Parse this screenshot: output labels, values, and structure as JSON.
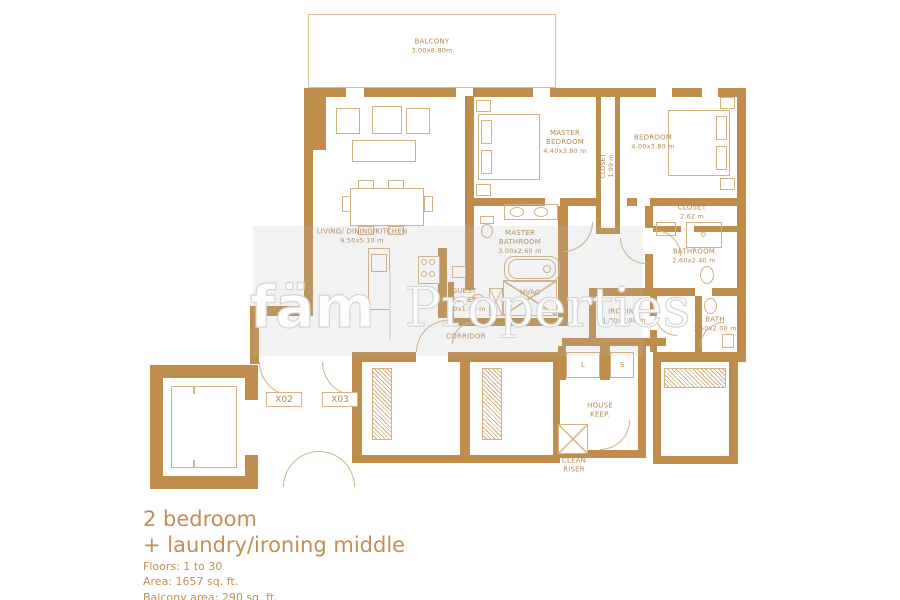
{
  "watermark": {
    "brand": "fäm",
    "name": "Properties"
  },
  "plan": {
    "balcony": {
      "name": "BALCONY",
      "dim": "3.00x8.80m"
    },
    "living": {
      "name": "LIVING/ DINING/KITCHEN",
      "dim": "9.50x5.10 m"
    },
    "master_bedroom": {
      "l1": "MASTER",
      "l2": "BEDROOM",
      "dim": "4.40x3.80 m"
    },
    "bedroom": {
      "name": "BEDROOM",
      "dim": "4.00x3.80 m"
    },
    "closet1": {
      "name": "CLOSET",
      "dim": "1.99 m"
    },
    "master_bathroom": {
      "l1": "MASTER",
      "l2": "BATHROOM",
      "dim": "3.00x2.60 m"
    },
    "guest_toilet": {
      "l1": "GUEST",
      "l2": "TOILET",
      "dim": "1.70x1.50 m"
    },
    "hvac": {
      "name": "HVAC"
    },
    "corridor": {
      "name": "CORRIDOR"
    },
    "closet2": {
      "name": "CLOSET",
      "dim": "2.62 m"
    },
    "bathroom": {
      "name": "BATHROOM",
      "dim": "2.60x2.40 m"
    },
    "bath": {
      "name": "BATH",
      "dim": "1.50x2.00 m"
    },
    "ironing": {
      "name": "IRONING",
      "dim": "1.80x2.00 m"
    },
    "house_keep": {
      "l1": "HOUSE",
      "l2": "KEEP."
    },
    "clean_riser": {
      "l1": "CLEAN",
      "l2": "RISER"
    },
    "unit_x02": "X02",
    "unit_x03": "X03",
    "appliance_l": "L",
    "appliance_s": "S"
  },
  "info": {
    "title_line1": "2 bedroom",
    "title_line2": "+ laundry/ironing middle",
    "floors": "Floors: 1 to 30",
    "area": "Area: 1657 sq. ft.",
    "balcony_area": "Balcony area: 290 sq. ft."
  },
  "colors": {
    "wall": "#bf8e4d",
    "furniture_line": "#d2b183",
    "label_text": "#b5874e"
  }
}
